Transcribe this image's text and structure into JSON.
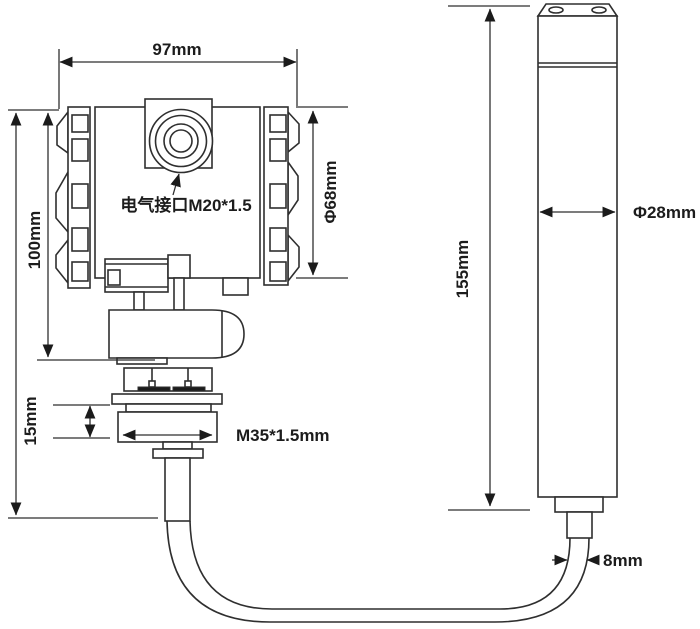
{
  "drawing": {
    "type": "technical-dimension-drawing",
    "subject": "pressure level transmitter with submersible probe and cable",
    "background_color": "#ffffff",
    "line_color": "#2f2f2f",
    "text_color": "#1c1c1c",
    "labels": {
      "body_width": "97mm",
      "body_height": "100mm",
      "thread_height": "15mm",
      "electrical_port": "电气接口M20*1.5",
      "body_diameter": "Φ68mm",
      "thread_spec": "M35*1.5mm",
      "probe_length": "155mm",
      "probe_diameter": "Φ28mm",
      "cable_diameter": "8mm"
    }
  }
}
